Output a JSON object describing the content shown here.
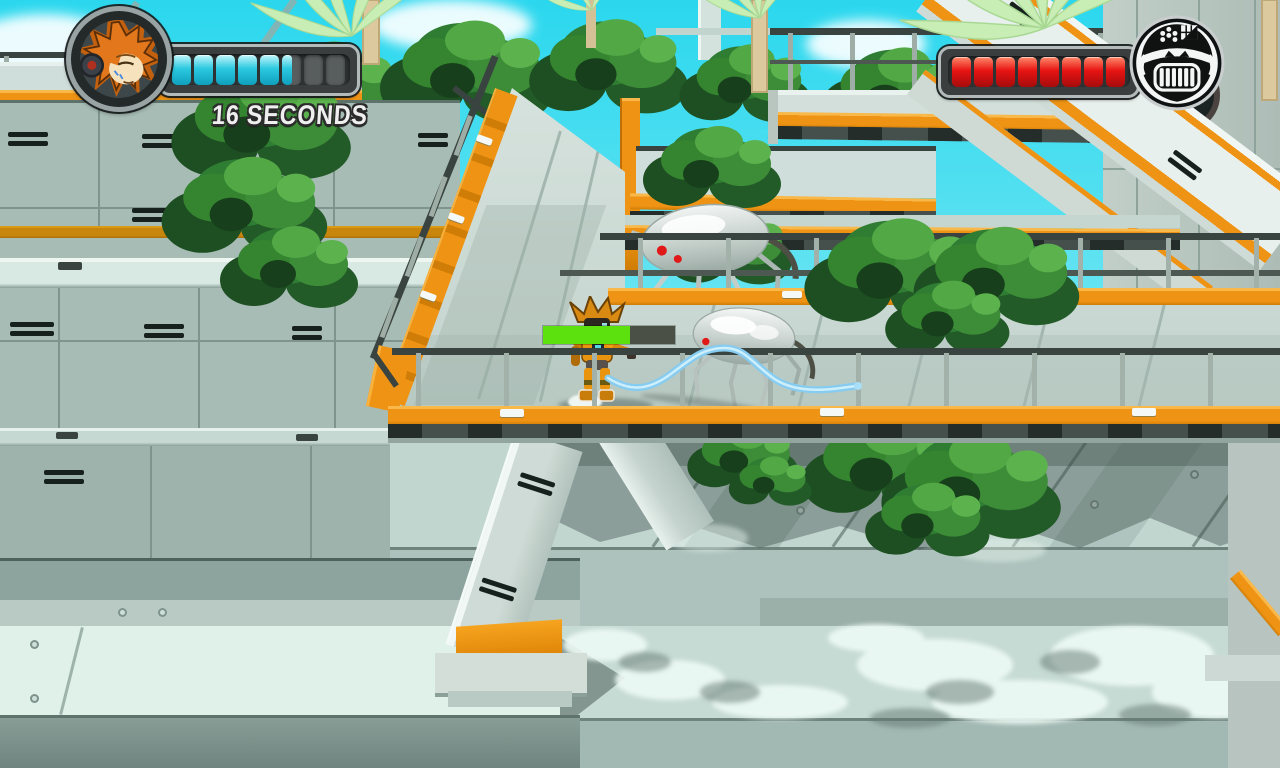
{
  "hud": {
    "timer": {
      "label": "16 SECONDS"
    },
    "player": {
      "portrait_icon": "hero-orange-hair-portrait",
      "health": {
        "total": 8,
        "filled": 5,
        "partial": 0.55,
        "fill_top": "#c2f6fa",
        "fill_mid": "#2cc9e0",
        "fill_bottom": "#0e9fbd",
        "empty": "#585d5e"
      }
    },
    "boss": {
      "portrait_icon": "angry-ape-bot-portrait",
      "health": {
        "total": 8,
        "filled": 8,
        "partial": 0,
        "fill_top": "#ff8a6a",
        "fill_mid": "#e81414",
        "fill_bottom": "#a50b0b",
        "empty": "#585d5e"
      }
    }
  },
  "world": {
    "charge_meter": {
      "percent": 66,
      "fill": "#5ce10f",
      "track": "#4b5046"
    },
    "entities": {
      "player": "orange-robot-with-energy-whip",
      "enemy_1": "spider-drone",
      "enemy_2": "spider-drone"
    },
    "colors": {
      "accent_orange": "#ef9314",
      "sky": "#35d7ec",
      "foliage": "#2f7d33",
      "whip_blue": "#86ccf1",
      "spider_eye_red": "#e01818"
    }
  }
}
